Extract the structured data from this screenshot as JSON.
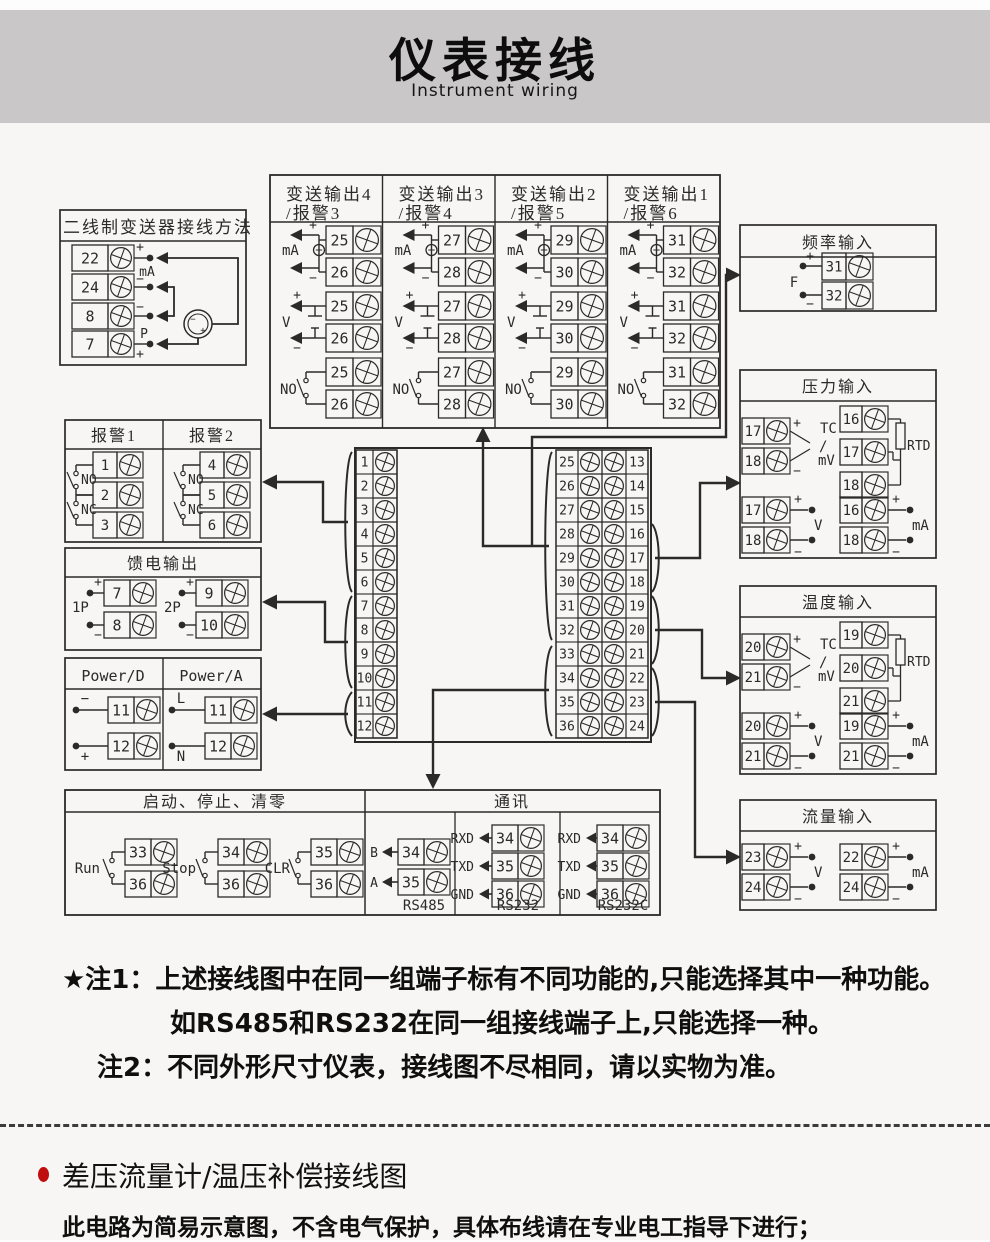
{
  "header": {
    "title": "仪表接线",
    "subtitle": "Instrument wiring"
  },
  "colors": {
    "band_gray": "#c9c7c8",
    "page_bg": "#f7f6f4",
    "line_dark": "#2b2a28",
    "bullet_red": "#c00d0d"
  },
  "diagram": {
    "two_wire": {
      "title": "二线制变送器接线方法",
      "terminals": [
        "22",
        "24",
        "8",
        "7"
      ],
      "labels": {
        "plus_top": "+",
        "ma": "mA",
        "minus_mid": "−",
        "minus_low": "−",
        "p": "P",
        "plus_bottom": "+"
      }
    },
    "transmit": {
      "columns": [
        {
          "title_line1": "变送输出4",
          "title_line2": "/报警3",
          "pair": [
            "25",
            "26"
          ]
        },
        {
          "title_line1": "变送输出3",
          "title_line2": "/报警4",
          "pair": [
            "27",
            "28"
          ]
        },
        {
          "title_line1": "变送输出2",
          "title_line2": "/报警5",
          "pair": [
            "29",
            "30"
          ]
        },
        {
          "title_line1": "变送输出1",
          "title_line2": "/报警6",
          "pair": [
            "31",
            "32"
          ]
        }
      ],
      "labels": {
        "ma": "mA",
        "v": "V",
        "no": "NO",
        "plus": "+",
        "minus": "−"
      }
    },
    "freq": {
      "title": "频率输入",
      "terminals": [
        "31",
        "32"
      ],
      "labels": {
        "plus": "+",
        "minus": "−",
        "f": "F"
      }
    },
    "pressure": {
      "title": "压力输入",
      "tc": {
        "terminals": [
          "17",
          "18"
        ],
        "lines": [
          "TC",
          "/",
          "mV"
        ],
        "plus": "+",
        "minus": "−"
      },
      "rtd": {
        "terminals": [
          "16",
          "17",
          "18"
        ],
        "label": "RTD"
      },
      "v": {
        "terminals": [
          "17",
          "18"
        ],
        "label": "V",
        "plus": "+",
        "minus": "−"
      },
      "ma": {
        "terminals": [
          "16",
          "18"
        ],
        "label": "mA",
        "plus": "+",
        "minus": "−"
      }
    },
    "temp": {
      "title": "温度输入",
      "tc": {
        "terminals": [
          "20",
          "21"
        ],
        "lines": [
          "TC",
          "/",
          "mV"
        ],
        "plus": "+",
        "minus": "−"
      },
      "rtd": {
        "terminals": [
          "19",
          "20",
          "21"
        ],
        "label": "RTD"
      },
      "v": {
        "terminals": [
          "20",
          "21"
        ],
        "label": "V",
        "plus": "+",
        "minus": "−"
      },
      "ma": {
        "terminals": [
          "19",
          "21"
        ],
        "label": "mA",
        "plus": "+",
        "minus": "−"
      }
    },
    "flow": {
      "title": "流量输入",
      "v": {
        "terminals": [
          "23",
          "24"
        ],
        "label": "V",
        "plus": "+",
        "minus": "−"
      },
      "ma": {
        "terminals": [
          "22",
          "24"
        ],
        "label": "mA",
        "plus": "+",
        "minus": "−"
      }
    },
    "alarm": {
      "columns": [
        {
          "title": "报警1",
          "terminals": [
            "1",
            "2",
            "3"
          ]
        },
        {
          "title": "报警2",
          "terminals": [
            "4",
            "5",
            "6"
          ]
        }
      ],
      "labels": {
        "no": "NO",
        "nc": "NC"
      }
    },
    "feed": {
      "title": "馈电输出",
      "groups": [
        {
          "label": "1P",
          "terminals": [
            "7",
            "8"
          ]
        },
        {
          "label": "2P",
          "terminals": [
            "9",
            "10"
          ]
        }
      ],
      "labels": {
        "plus": "+",
        "minus": "−"
      }
    },
    "power": {
      "columns": [
        {
          "title": "Power/D",
          "rows": [
            {
              "num": "11",
              "label": "−"
            },
            {
              "num": "12",
              "label": "+"
            }
          ]
        },
        {
          "title": "Power/A",
          "rows": [
            {
              "num": "11",
              "label": "L"
            },
            {
              "num": "12",
              "label": "N"
            }
          ]
        }
      ]
    },
    "center": {
      "left": [
        "1",
        "2",
        "3",
        "4",
        "5",
        "6",
        "7",
        "8",
        "9",
        "10",
        "11",
        "12"
      ],
      "mid": [
        "25",
        "26",
        "27",
        "28",
        "29",
        "30",
        "31",
        "32",
        "33",
        "34",
        "35",
        "36"
      ],
      "right": [
        "13",
        "14",
        "15",
        "16",
        "17",
        "18",
        "19",
        "20",
        "21",
        "22",
        "23",
        "24"
      ]
    },
    "run_stop": {
      "title": "启动、停止、清零",
      "switches": [
        {
          "label": "Run",
          "terminals": [
            "33",
            "36"
          ]
        },
        {
          "label": "Stop",
          "terminals": [
            "34",
            "36"
          ]
        },
        {
          "label": "CLR",
          "terminals": [
            "35",
            "36"
          ]
        }
      ]
    },
    "comm": {
      "title": "通讯",
      "sections": [
        {
          "label": "RS485",
          "pins": [
            {
              "sig": "B",
              "num": "34"
            },
            {
              "sig": "A",
              "num": "35"
            }
          ]
        },
        {
          "label": "RS232",
          "pins": [
            {
              "sig": "RXD",
              "num": "34"
            },
            {
              "sig": "TXD",
              "num": "35"
            },
            {
              "sig": "GND",
              "num": "36"
            }
          ]
        },
        {
          "label": "RS232C",
          "pins": [
            {
              "sig": "RXD",
              "num": "34"
            },
            {
              "sig": "TXD",
              "num": "35"
            },
            {
              "sig": "GND",
              "num": "36"
            }
          ]
        }
      ]
    }
  },
  "notes": {
    "note1_line1": "★注1：上述接线图中在同一组端子标有不同功能的,只能选择其中一种功能。",
    "note1_line2": "如RS485和RS232在同一组接线端子上,只能选择一种。",
    "note2": "注2：不同外形尺寸仪表，接线图不尽相同，请以实物为准。"
  },
  "section2": {
    "heading": "差压流量计/温压补偿接线图",
    "body": "此电路为简易示意图，不含电气保护，具体布线请在专业电工指导下进行；"
  }
}
